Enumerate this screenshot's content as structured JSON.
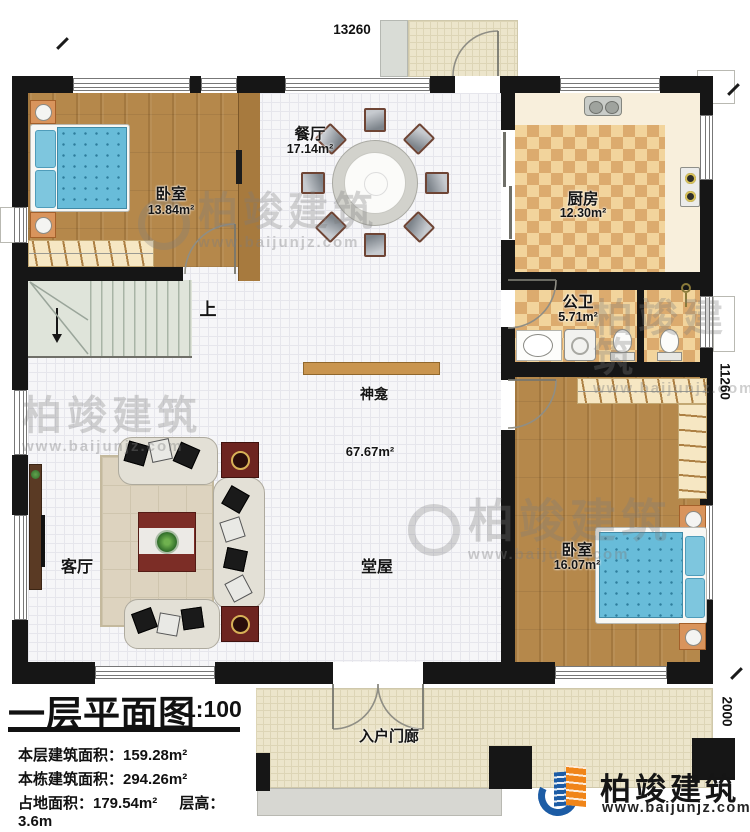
{
  "plan": {
    "dim_top": "13260",
    "dim_right": "11260",
    "dim_bottom_right": "2000",
    "rooms": {
      "bedroom1": {
        "name": "卧室",
        "area": "13.84m²"
      },
      "dining": {
        "name": "餐厅",
        "area": "17.14m²"
      },
      "kitchen": {
        "name": "厨房",
        "area": "12.30m²"
      },
      "bathroom": {
        "name": "公卫",
        "area": "5.71m²"
      },
      "hall": {
        "name": "堂屋",
        "area": "67.67m²"
      },
      "bedroom2": {
        "name": "卧室",
        "area": "16.07m²"
      },
      "living": {
        "name": "客厅"
      },
      "entry_porch": {
        "name": "入户门廊"
      }
    },
    "annotations": {
      "stairs_up": "上",
      "shrine": "神龛"
    }
  },
  "title_block": {
    "title": "一层平面图",
    "scale": "1:100",
    "stat1": "本层建筑面积：159.28m²",
    "stat2": "本栋建筑面积：294.26m²",
    "stat3": "占地面积：179.54m²",
    "stat4": "层高：3.6m"
  },
  "brand": {
    "name": "柏竣建筑",
    "website": "www.baijunjz.com"
  },
  "watermark": {
    "name": "柏竣建筑",
    "website": "www.baijunjz.com"
  }
}
